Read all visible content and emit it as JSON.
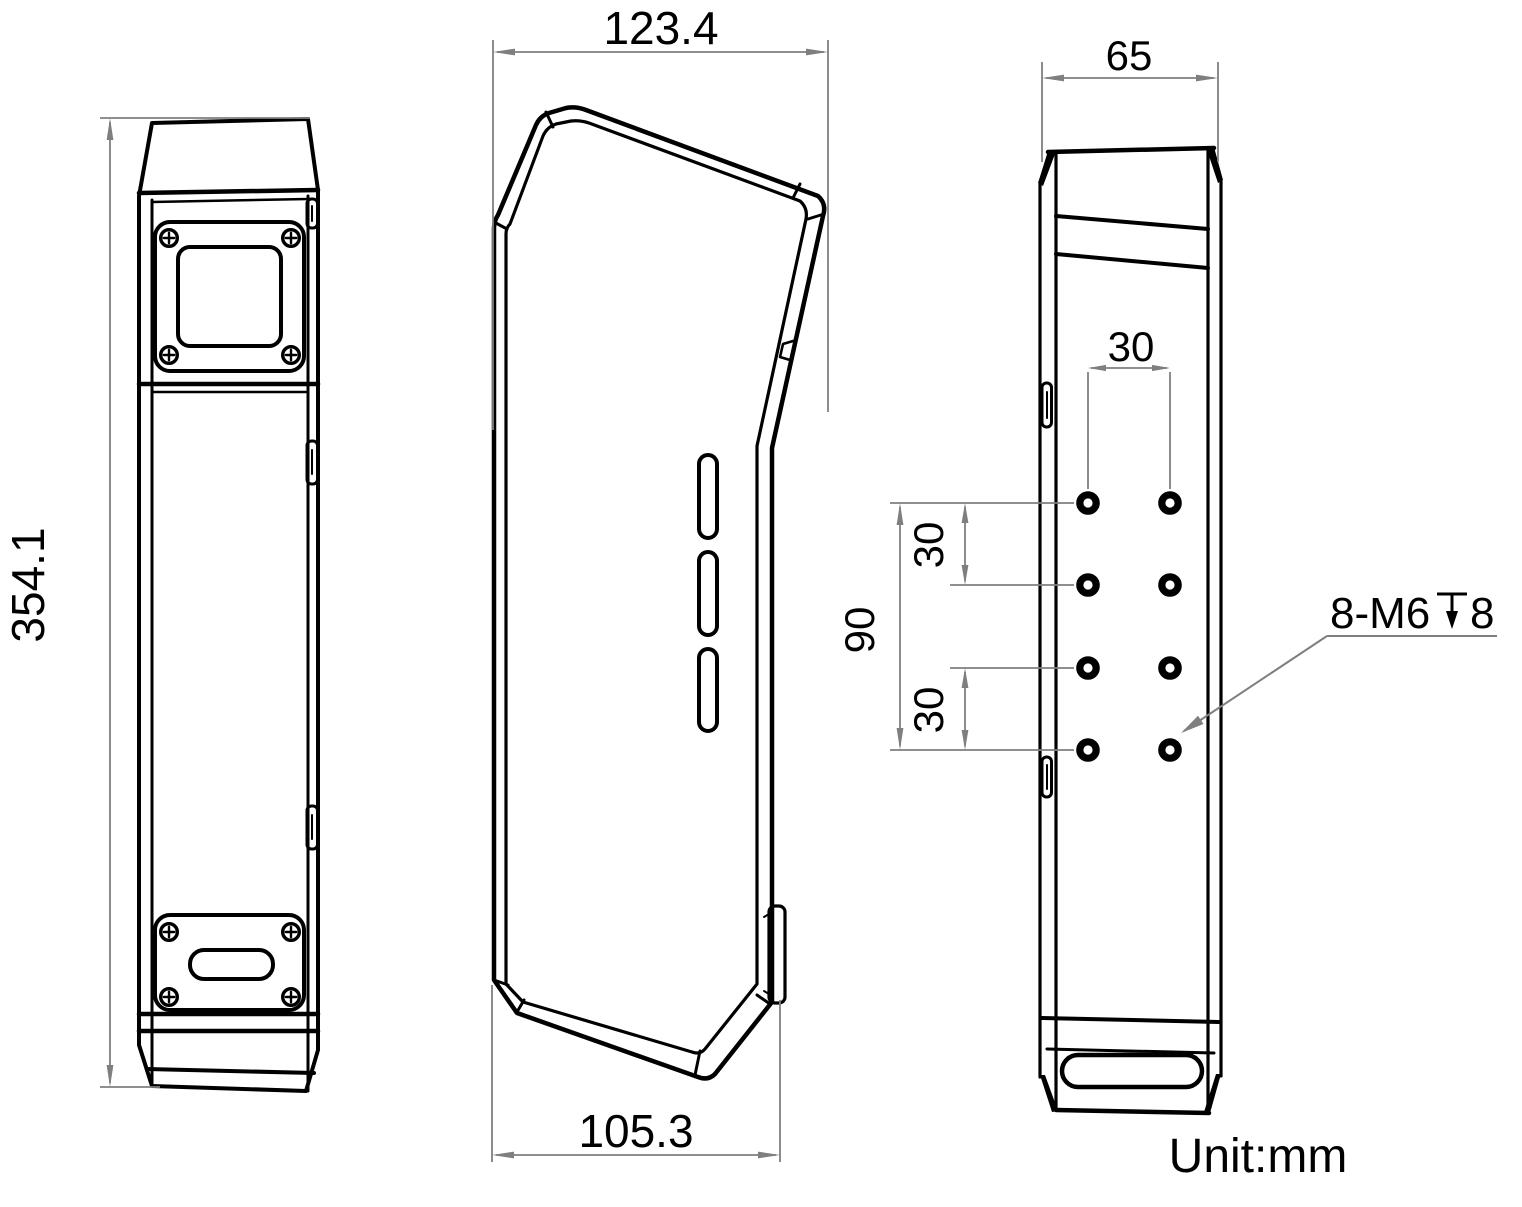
{
  "drawing": {
    "unit_label": "Unit:mm",
    "dimensions": {
      "front_height": "354.1",
      "side_top_width": "123.4",
      "side_bottom_width": "105.3",
      "back_width": "65",
      "hole_column_spacing": "30",
      "hole_vertical_span": "90",
      "hole_row_spacing_upper": "30",
      "hole_row_spacing_lower": "30"
    },
    "thread_callout": {
      "prefix": "8-M6",
      "depth_value": "8",
      "full_label": "8-M6⊽8"
    },
    "colors": {
      "line": "#000000",
      "dimension": "#7f7f7f",
      "background": "#ffffff"
    }
  }
}
